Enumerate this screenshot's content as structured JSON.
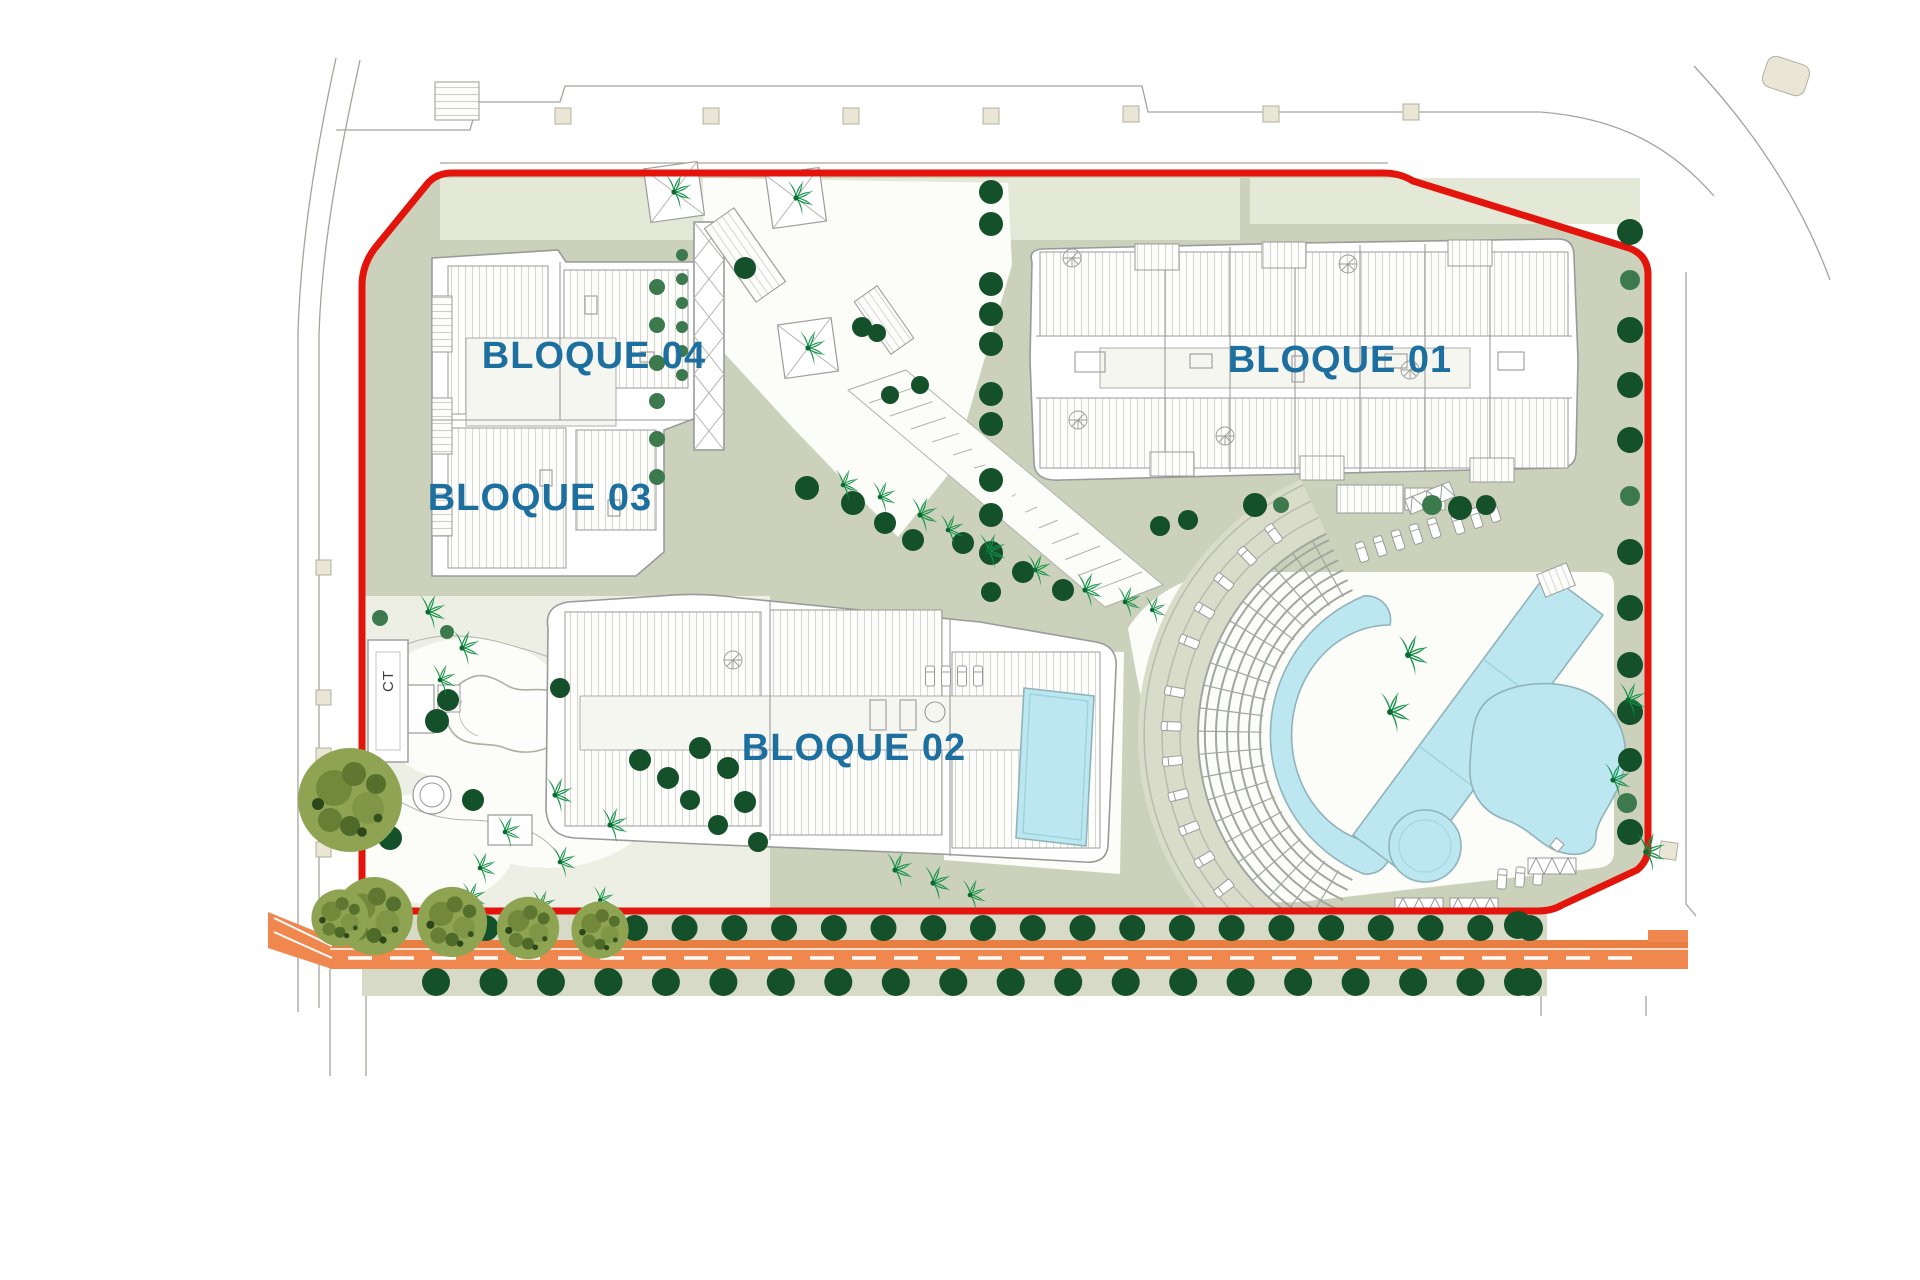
{
  "plan": {
    "labels": {
      "block_01": "BLOQUE 01",
      "block_02": "BLOQUE 02",
      "block_03": "BLOQUE 03",
      "block_04": "BLOQUE 04",
      "transformer": "CT"
    },
    "colors": {
      "boundary_red": "#e3140c",
      "label_blue": "#1c6f9f",
      "road_orange": "#f0874e",
      "road_orange_dark": "#e87e41",
      "road_dash_white": "#ffffff",
      "pool_blue": "#bce7f0",
      "pool_edge": "#8fb3ba",
      "ground_sage": "#cbd1ba",
      "ground_strip": "#d6dac6",
      "ground_garden": "#edefe4",
      "ground_pale": "#e4e8d7",
      "plaza_white": "#fcfcf9",
      "tree_dark": "#14502a",
      "tree_medium": "#3c7a4e",
      "palm_green": "#129146",
      "olive_green": "#8ea452",
      "building_line": "#9a9a9a",
      "paving_beige": "#e9e6d6"
    },
    "tree_rows": {
      "above_road": 23,
      "below_road": 20
    }
  }
}
